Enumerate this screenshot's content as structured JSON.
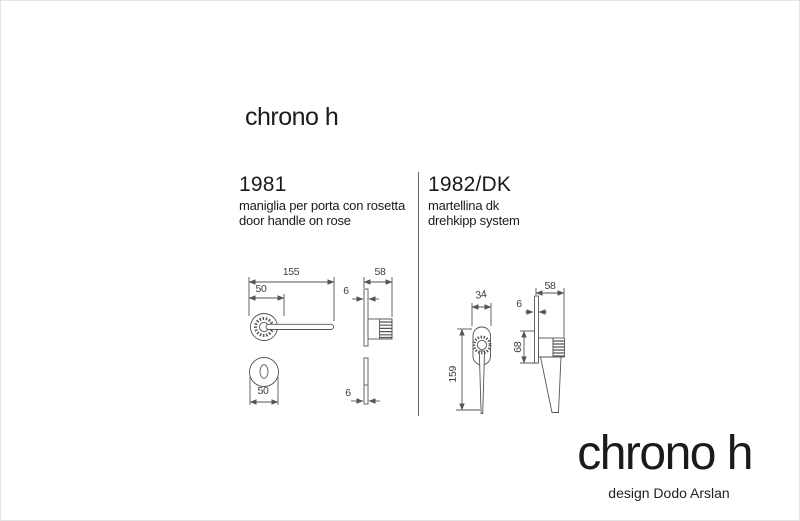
{
  "header": {
    "title": "chrono h"
  },
  "products": [
    {
      "code": "1981",
      "description_line1": "maniglia per porta con rosetta",
      "description_line2": "door handle on rose",
      "dims": {
        "overall": "155",
        "rose": "50",
        "depth": "58",
        "thickness": "6",
        "esc_width": "50",
        "esc_thickness": "6"
      }
    },
    {
      "code": "1982/DK",
      "description_line1": "martellina dk",
      "description_line2": "drehkipp system",
      "dims": {
        "width": "34",
        "height": "159",
        "depth": "58",
        "thickness": "6",
        "grip": "68"
      }
    }
  ],
  "footer": {
    "brand": "chrono h",
    "credit": "design Dodo Arslan"
  },
  "colors": {
    "background": "#ffffff",
    "line": "#555555",
    "text": "#1b1b1b",
    "dim_text": "#3d3d3d"
  }
}
